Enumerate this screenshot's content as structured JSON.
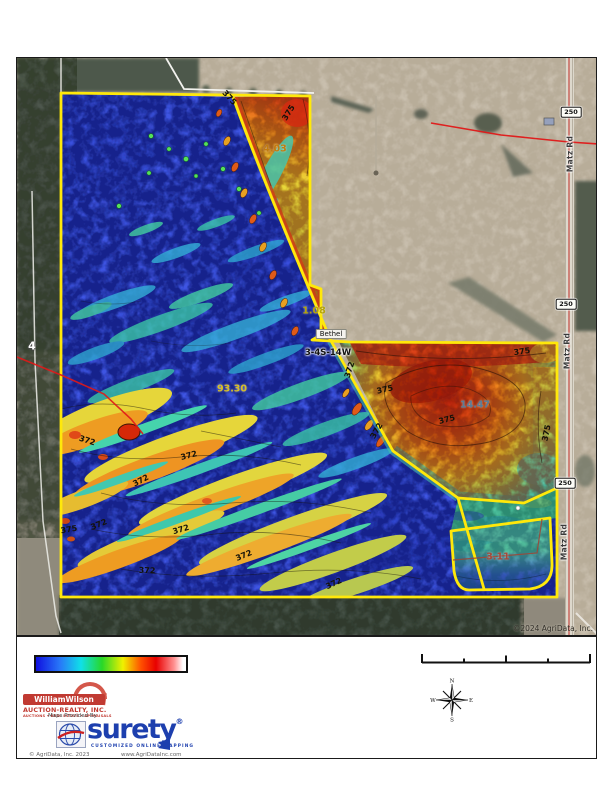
{
  "map": {
    "credit": "©2024 AgriData, Inc.",
    "place_label": "Bethel",
    "section_label": "3-4S-14W",
    "route_marker": "4",
    "acreage_labels": [
      {
        "text": "4.03",
        "color": "#c27c10"
      },
      {
        "text": "1.08",
        "color": "#b5a409"
      },
      {
        "text": "93.30",
        "color": "#d8c026"
      },
      {
        "text": "14.47",
        "color": "#5a7d96"
      },
      {
        "text": "3.11",
        "color": "#a34a3a"
      }
    ],
    "contour_labels": [
      {
        "text": "375"
      },
      {
        "text": "375"
      },
      {
        "text": "372"
      },
      {
        "text": "375"
      },
      {
        "text": "375"
      },
      {
        "text": "375"
      },
      {
        "text": "375"
      },
      {
        "text": "372"
      },
      {
        "text": "372"
      },
      {
        "text": "372"
      },
      {
        "text": "372"
      },
      {
        "text": "375"
      },
      {
        "text": "372"
      },
      {
        "text": "372"
      },
      {
        "text": "372"
      },
      {
        "text": "372"
      },
      {
        "text": "372"
      }
    ],
    "road_shields": [
      {
        "text": "250"
      },
      {
        "text": "250"
      },
      {
        "text": "250"
      }
    ],
    "road_names": [
      {
        "text": "Matz Rd"
      },
      {
        "text": "Matz Rd"
      },
      {
        "text": "Matz Rd"
      }
    ]
  },
  "legend": {
    "colors": [
      "#1010e0",
      "#10e0e8",
      "#28d828",
      "#f0f000",
      "#e80000",
      "#ffffff"
    ]
  },
  "compass": {
    "north": "N",
    "south": "S",
    "east": "E",
    "west": "W"
  },
  "branding": {
    "firm_name": "WilliamWilson",
    "firm_line2": "AUCTION-REALTY, INC.",
    "firm_line3": "AUCTIONS • REAL ESTATE • APPRAISALS",
    "maps_provided_by": "Maps Provided By",
    "surety_name": "surety",
    "surety_reg": "®",
    "surety_tagline": "CUSTOMIZED ONLINE MAPPING",
    "agridata_copyright": "© AgriData, Inc. 2023",
    "agridata_website": "www.AgriDataInc.com"
  }
}
